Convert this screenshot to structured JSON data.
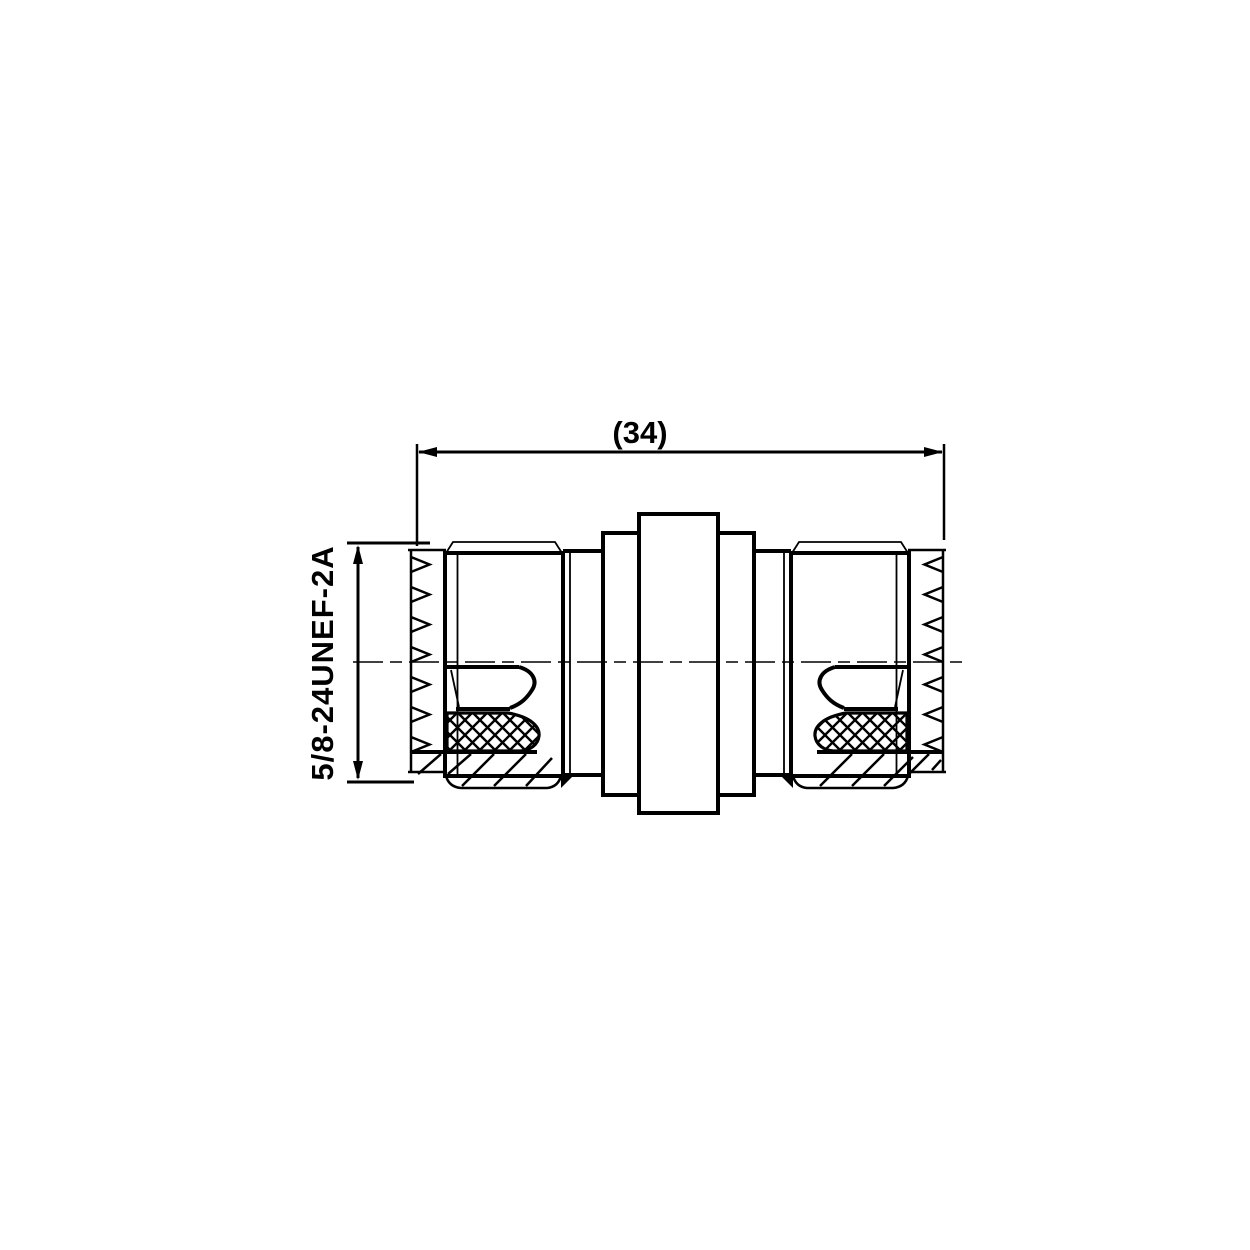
{
  "page": {
    "background_color": "#ffffff",
    "line_color": "#000000"
  },
  "drawing": {
    "type": "engineering-2d-section-view",
    "description": "Coaxial barrel adapter, double-female, side cross-section view"
  },
  "labels": {
    "overall_length": "(34)",
    "thread_spec": "5/8-24UNEF-2A"
  },
  "dimensions": {
    "overall_length_value": 34,
    "overall_length_is_reference": true,
    "thread_designation": "5/8-24UNEF-2A"
  }
}
